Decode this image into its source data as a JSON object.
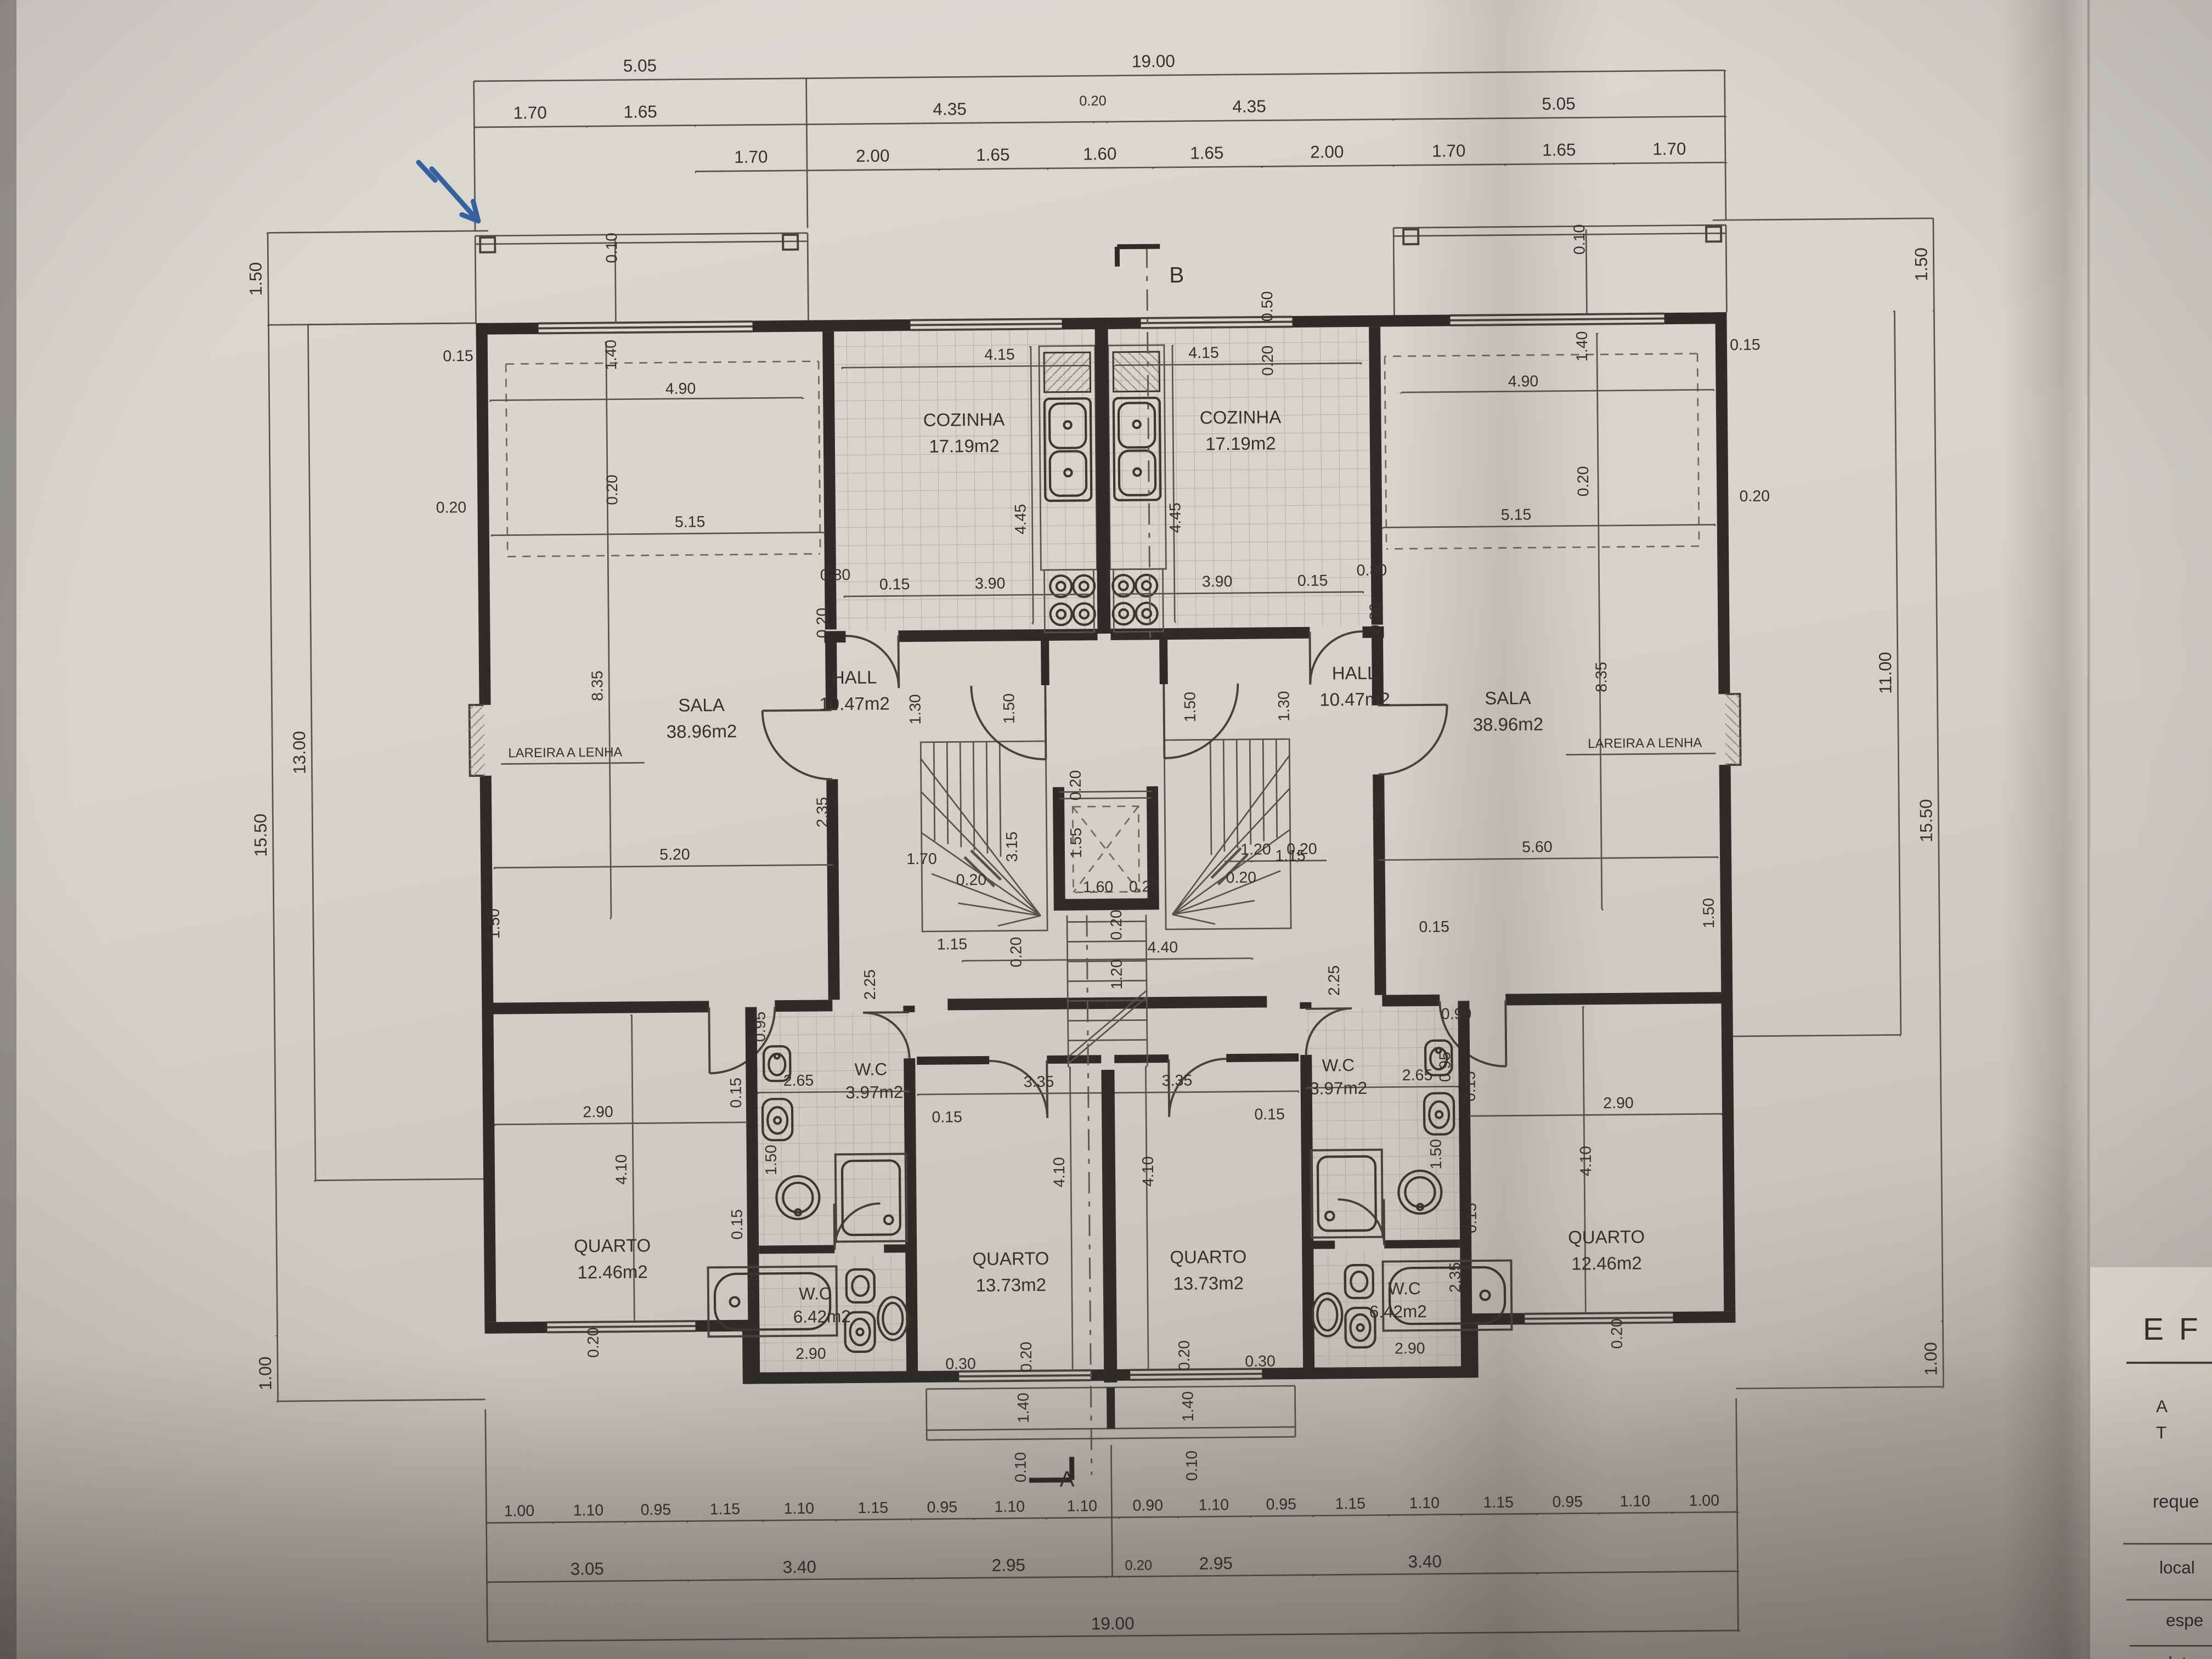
{
  "palette": {
    "paper": "#d7d4cd",
    "ink": "#35322c",
    "dim_line": "#57544c",
    "shadow": "#8b8880",
    "pen_blue": "#35619f"
  },
  "markers": {
    "section_top": "B",
    "section_bottom": "A"
  },
  "rooms": {
    "cozinha": {
      "name": "COZINHA",
      "area": "17.19m2"
    },
    "sala": {
      "name": "SALA",
      "area": "38.96m2"
    },
    "hall": {
      "name": "HALL",
      "area": "10.47m2"
    },
    "quarto_center": {
      "name": "QUARTO",
      "area": "13.73m2"
    },
    "quarto_corner": {
      "name": "QUARTO",
      "area": "12.46m2"
    },
    "wc_small": {
      "name": "W.C",
      "area": "3.97m2"
    },
    "wc_large": {
      "name": "W.C",
      "area": "6.42m2"
    },
    "fireplace_label": "LAREIRA A LENHA"
  },
  "chains": {
    "top_a": [
      "5.05",
      "19.00"
    ],
    "top_b": [
      "1.70",
      "1.65",
      "4.35",
      "0.20",
      "4.35",
      "5.05"
    ],
    "top_c": [
      "1.70",
      "2.00",
      "1.65",
      "1.60",
      "1.65",
      "2.00",
      "1.70",
      "1.65",
      "1.70"
    ],
    "bottom_a": [
      "1.00",
      "1.10",
      "0.95",
      "1.15",
      "1.10",
      "1.15",
      "0.95",
      "1.10",
      "1.10",
      "0.90",
      "1.10",
      "0.95",
      "1.15",
      "1.10",
      "1.15",
      "0.95",
      "1.10",
      "1.00"
    ],
    "bottom_b": [
      "3.05",
      "3.40",
      "2.95",
      "0.20",
      "2.95",
      "3.40"
    ],
    "bottom_total": "19.00",
    "left_col": [
      "1.50",
      "15.50",
      "13.00",
      "1.00"
    ],
    "right_col": [
      "1.50",
      "11.00",
      "15.50",
      "1.00"
    ]
  },
  "v": {
    "010": "0.10",
    "015": "0.15",
    "020": "0.20",
    "030": "0.30",
    "050": "0.50",
    "080": "0.80",
    "090": "0.90",
    "095": "0.95",
    "115": "1.15",
    "120": "1.20",
    "130": "1.30",
    "140": "1.40",
    "150": "1.50",
    "155": "1.55",
    "160": "1.60",
    "170": "1.70",
    "225": "2.25",
    "235": "2.35",
    "265": "2.65",
    "290": "2.90",
    "315": "3.15",
    "335": "3.35",
    "390": "3.90",
    "410": "4.10",
    "415": "4.15",
    "440": "4.40",
    "445": "4.45",
    "490": "4.90",
    "515": "5.15",
    "520": "5.20",
    "560": "5.60",
    "835": "8.35"
  },
  "title_block": {
    "heading": "E F",
    "partial_a": "A",
    "partial_t": "T",
    "field_requerente": "reque",
    "field_local": "local",
    "field_especialidade": "espe",
    "field_data": "data"
  }
}
